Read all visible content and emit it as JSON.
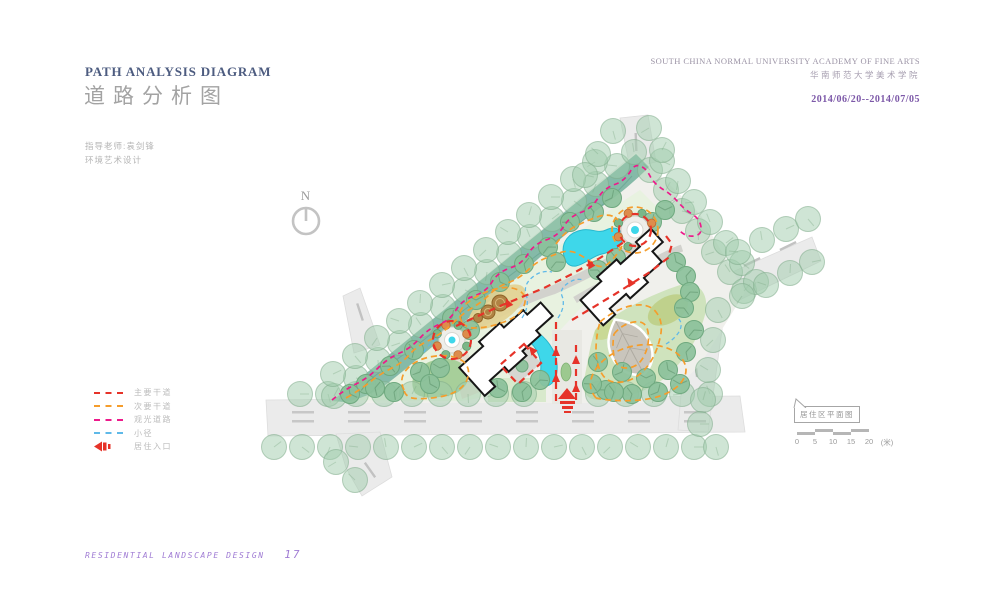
{
  "header": {
    "title_en": "PATH ANALYSIS DIAGRAM",
    "title_zh": "道路分析图",
    "school_en": "SOUTH CHINA NORMAL UNIVERSITY ACADEMY OF FINE ARTS",
    "school_zh": "华南师范大学美术学院",
    "date_range": "2014/06/20--2014/07/05"
  },
  "info": {
    "instructor": "指导老师:袁剑锋",
    "major": "环境艺术设计"
  },
  "north_label": "N",
  "legend": {
    "items": [
      {
        "label": "主要干道",
        "color": "#e63329",
        "type": "dash"
      },
      {
        "label": "次要干道",
        "color": "#f59d2c",
        "type": "dash"
      },
      {
        "label": "观光道路",
        "color": "#ed1a8b",
        "type": "dash"
      },
      {
        "label": "小径",
        "color": "#5fb9e8",
        "type": "dash"
      },
      {
        "label": "居住入口",
        "color": "#e63329",
        "type": "arrow"
      }
    ]
  },
  "callout_label": "居住区平面图",
  "scalebar": {
    "ticks": [
      "0",
      "5",
      "10",
      "15",
      "20"
    ],
    "unit": "(米)"
  },
  "footer": {
    "text": "RESIDENTIAL LANDSCAPE DESIGN",
    "page": "17"
  },
  "colors": {
    "title_blue": "#4d5c80",
    "accent_purple": "#7c58a8",
    "footer_purple": "#a07cd4",
    "main_road": "#e63329",
    "secondary_road": "#f59d2c",
    "sightseeing_road": "#ed1a8b",
    "small_path": "#5fb9e8",
    "water": "#3ed7ea"
  }
}
